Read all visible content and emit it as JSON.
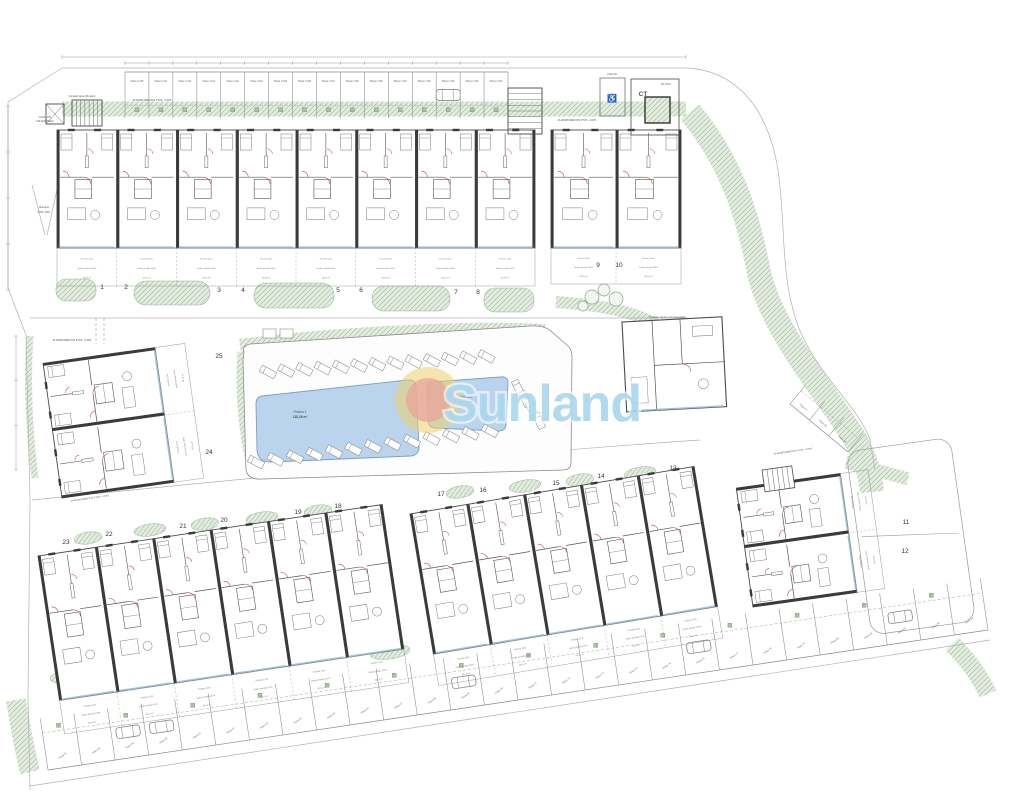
{
  "title": "Residential development site plan",
  "logo": {
    "text": "Sunland",
    "text_color": "#a7d6ee",
    "sun_outer_color": "#f1cf6d",
    "sun_inner_color": "#e9a69c",
    "cx": 428,
    "cy": 400,
    "r_outer": 33,
    "r_inner": 22,
    "text_x": 443,
    "text_y": 421,
    "font_size": 52
  },
  "plan": {
    "colors": {
      "wall": "#3a3a3a",
      "line": "#6a6a6a",
      "faint": "#b0b0b0",
      "red": "#c0392b",
      "blue": "#8fc1dd",
      "pool_fill": "#b9d4ec",
      "pool_edge": "#7d9fc0",
      "green_fill": "#e3ecdf",
      "green_line": "#9cb89c",
      "text": "#444444"
    },
    "terrace_text": [
      "Parcela 123a",
      "Jardín privado 100%",
      "58,16 m²"
    ],
    "unit_numbers": [
      {
        "n": "1",
        "x": 102,
        "y": 289
      },
      {
        "n": "2",
        "x": 126,
        "y": 289
      },
      {
        "n": "3",
        "x": 219,
        "y": 292
      },
      {
        "n": "4",
        "x": 243,
        "y": 292
      },
      {
        "n": "5",
        "x": 338,
        "y": 292
      },
      {
        "n": "6",
        "x": 361,
        "y": 292
      },
      {
        "n": "7",
        "x": 456,
        "y": 294
      },
      {
        "n": "8",
        "x": 478,
        "y": 294
      },
      {
        "n": "9",
        "x": 598,
        "y": 267
      },
      {
        "n": "10",
        "x": 619,
        "y": 267
      },
      {
        "n": "25",
        "x": 219,
        "y": 358
      },
      {
        "n": "24",
        "x": 209,
        "y": 454
      },
      {
        "n": "23",
        "x": 66,
        "y": 544
      },
      {
        "n": "22",
        "x": 109,
        "y": 536
      },
      {
        "n": "21",
        "x": 183,
        "y": 528
      },
      {
        "n": "20",
        "x": 224,
        "y": 522
      },
      {
        "n": "19",
        "x": 298,
        "y": 514
      },
      {
        "n": "18",
        "x": 338,
        "y": 508
      },
      {
        "n": "17",
        "x": 441,
        "y": 496
      },
      {
        "n": "16",
        "x": 483,
        "y": 492
      },
      {
        "n": "15",
        "x": 556,
        "y": 485
      },
      {
        "n": "14",
        "x": 601,
        "y": 478
      },
      {
        "n": "13",
        "x": 673,
        "y": 470
      },
      {
        "n": "11",
        "x": 906,
        "y": 524
      },
      {
        "n": "12",
        "x": 905,
        "y": 553
      }
    ],
    "annotations": [
      {
        "text": "CHALAN",
        "x": 45,
        "y": 118,
        "size": 3
      },
      {
        "text": "DE ESPERA",
        "x": 45,
        "y": 122,
        "size": 3
      },
      {
        "text": "Contador agua (26 apart)",
        "x": 82,
        "y": 97,
        "size": 2.4
      },
      {
        "text": "26 APARTAMENTOS PTOS - COPS",
        "x": 152,
        "y": 101,
        "size": 2.4
      },
      {
        "text": "26 APARTAMENTOS PTOS - COPS",
        "x": 577,
        "y": 121,
        "size": 2.4
      },
      {
        "text": "Rampa",
        "x": 44,
        "y": 208,
        "size": 3
      },
      {
        "text": "PTE 16%",
        "x": 44,
        "y": 213,
        "size": 3
      },
      {
        "text": "26 APARTAMENTOS PTOS - COPS",
        "x": 72,
        "y": 341,
        "size": 2.4
      },
      {
        "text": "26 APARTAMENTOS PTOS - COPS",
        "x": 90,
        "y": 499,
        "size": 2.4,
        "rot": -8
      },
      {
        "text": "26 APARTAMENTOS PTOS - COPS",
        "x": 793,
        "y": 452,
        "size": 2.4,
        "rot": -8
      },
      {
        "text": "Contador agua y luz comunidad",
        "x": 667,
        "y": 318,
        "size": 2.6
      },
      {
        "text": "CT",
        "x": 643,
        "y": 96,
        "size": 6.5,
        "bold": true
      },
      {
        "text": "22,75m²",
        "x": 666,
        "y": 85,
        "size": 2.8
      },
      {
        "text": "Plaza 99",
        "x": 612,
        "y": 75,
        "size": 2.4
      },
      {
        "text": "♿",
        "x": 612,
        "y": 101,
        "size": 8
      },
      {
        "text": "Piscina 1",
        "x": 300,
        "y": 413,
        "size": 3.2
      },
      {
        "text": "138,26 m²",
        "x": 300,
        "y": 418,
        "size": 3.2,
        "bold": true
      },
      {
        "text": "Piscina 2",
        "x": 466,
        "y": 398,
        "size": 3.2
      },
      {
        "text": "56,06 m²",
        "x": 466,
        "y": 403,
        "size": 3.2,
        "bold": true
      }
    ],
    "blocks": [
      {
        "name": "block-units-1-8",
        "x": 57,
        "y": 130,
        "w": 478,
        "h": 118,
        "units": 8,
        "rot": 0,
        "terrace": 38
      },
      {
        "name": "block-units-9-10",
        "x": 551,
        "y": 130,
        "w": 130,
        "h": 118,
        "units": 2,
        "rot": 0,
        "terrace": 36
      },
      {
        "name": "block-units-24-25",
        "x": 62,
        "y": 498,
        "w": 136,
        "h": 113,
        "units": 2,
        "rot": -98,
        "terrace": 30
      },
      {
        "name": "block-units-18-23",
        "x": 38,
        "y": 556,
        "w": 348,
        "h": 146,
        "units": 6,
        "rot": -8.5,
        "terrace": 34
      },
      {
        "name": "block-units-13-17",
        "x": 410,
        "y": 514,
        "w": 288,
        "h": 142,
        "units": 5,
        "rot": -9.5,
        "terrace": 32
      },
      {
        "name": "block-units-11-12",
        "x": 753,
        "y": 607,
        "w": 120,
        "h": 105,
        "units": 2,
        "rot": -98,
        "terrace": 28
      }
    ],
    "pools": [
      {
        "name": "piscina-1",
        "d": "M 262,396 L 408,380 Q 416,379 416,387 L 419,447 Q 419,455 411,456 L 272,462 Q 258,463 257,450 L 256,404 Q 256,397 262,396 Z"
      },
      {
        "name": "piscina-2",
        "d": "M 432,382 L 500,377 Q 508,376 508,383 L 506,424 Q 506,431 498,431 L 436,428 Q 428,428 428,420 L 427,389 Q 427,382 432,382 Z"
      }
    ],
    "pool_enclosure": "M 244,352 Q 242,346 250,344 L 530,326 Q 545,325 552,332 L 568,346 Q 572,350 572,356 L 571,462 Q 571,470 563,470 L 262,479 Q 248,480 246,470 L 243,360 Z",
    "equip_boxes": [
      [
        263,
        329,
        13,
        9
      ],
      [
        280,
        329,
        13,
        9
      ]
    ],
    "lounger_rows": [
      {
        "x": 268,
        "y": 372,
        "n": 13,
        "dx": 18.2,
        "dy": -1.3,
        "ang": -62
      },
      {
        "x": 256,
        "y": 462,
        "n": 13,
        "dx": 19.5,
        "dy": -2.6,
        "ang": -62
      },
      {
        "x": 518,
        "y": 388,
        "n": 4,
        "dx": 7,
        "dy": 11,
        "ang": -25
      }
    ],
    "green_bands": [
      {
        "d": "M 62,109 H 686",
        "w": 15
      },
      {
        "d": "M 690,112 C 730,160 748,215 758,268 C 768,322 816,380 848,428 C 862,448 870,470 872,492",
        "w": 24
      },
      {
        "d": "M 556,302 C 615,306 655,316 676,340",
        "w": 12
      },
      {
        "d": "M 240,346 C 330,334 470,327 545,331",
        "w": 14
      },
      {
        "d": "M 242,352 C 239,392 243,432 252,470",
        "w": 9
      },
      {
        "d": "M 846,462 L 908,479",
        "w": 13
      },
      {
        "d": "M 30,336 C 27,380 29,430 35,478",
        "w": 7
      },
      {
        "d": "M 952,644 C 968,660 980,676 988,694",
        "w": 18
      },
      {
        "d": "M 16,700 C 20,724 24,748 30,772",
        "w": 20
      }
    ],
    "hedges": [
      {
        "x": 56,
        "y": 279,
        "w": 40,
        "h": 22,
        "rx": 10
      },
      {
        "x": 134,
        "y": 281,
        "w": 76,
        "h": 24,
        "rx": 12
      },
      {
        "x": 254,
        "y": 283,
        "w": 80,
        "h": 25,
        "rx": 12
      },
      {
        "x": 372,
        "y": 286,
        "w": 78,
        "h": 25,
        "rx": 12
      },
      {
        "x": 484,
        "y": 288,
        "w": 50,
        "h": 24,
        "rx": 11
      }
    ],
    "bushes": [
      {
        "cx": 88,
        "cy": 538,
        "rx": 14,
        "ry": 6,
        "rot": -8
      },
      {
        "cx": 150,
        "cy": 530,
        "rx": 16,
        "ry": 6,
        "rot": -8
      },
      {
        "cx": 205,
        "cy": 524,
        "rx": 14,
        "ry": 6,
        "rot": -8
      },
      {
        "cx": 262,
        "cy": 518,
        "rx": 16,
        "ry": 6,
        "rot": -8
      },
      {
        "cx": 318,
        "cy": 511,
        "rx": 14,
        "ry": 6,
        "rot": -8
      },
      {
        "cx": 460,
        "cy": 492,
        "rx": 14,
        "ry": 6,
        "rot": -9
      },
      {
        "cx": 525,
        "cy": 486,
        "rx": 16,
        "ry": 6,
        "rot": -9
      },
      {
        "cx": 580,
        "cy": 480,
        "rx": 14,
        "ry": 6,
        "rot": -9
      },
      {
        "cx": 640,
        "cy": 473,
        "rx": 16,
        "ry": 6,
        "rot": -9
      },
      {
        "cx": 70,
        "cy": 676,
        "rx": 20,
        "ry": 7,
        "rot": -8
      },
      {
        "cx": 245,
        "cy": 666,
        "rx": 26,
        "ry": 7,
        "rot": -8
      },
      {
        "cx": 390,
        "cy": 652,
        "rx": 20,
        "ry": 7,
        "rot": -8
      }
    ],
    "trees": [
      {
        "cx": 592,
        "cy": 297,
        "r": 7
      },
      {
        "cx": 604,
        "cy": 290,
        "r": 6
      },
      {
        "cx": 616,
        "cy": 299,
        "r": 7
      },
      {
        "cx": 583,
        "cy": 306,
        "r": 5
      }
    ],
    "lines": [
      {
        "d": "M 8,102 L 62,68"
      },
      {
        "d": "M 62,68 H 688"
      },
      {
        "d": "M 8,102 L 8,288 L 26,335 L 30,500 L 28,698 L 30,790"
      },
      {
        "d": "M 688,68 C 745,72 770,120 778,170 C 786,225 780,270 796,320 C 812,370 860,408 870,440 L 875,470"
      },
      {
        "d": "M 30,318 H 688"
      },
      {
        "d": "M 96,318 V 344",
        "dash": "3,2"
      },
      {
        "d": "M 104,318 V 344",
        "dash": "3,2"
      },
      {
        "d": "M 538,332 V 470",
        "dash": "3,2"
      },
      {
        "d": "M 547,332 V 468",
        "dash": "3,2"
      },
      {
        "d": "M 32,500 C 250,478 520,452 700,440"
      },
      {
        "d": "M 30,786 L 990,640"
      },
      {
        "d": "M 32,185 L 45,235"
      },
      {
        "d": "M 58,185 L 47,235"
      }
    ],
    "garden_enclosure_11_12": {
      "x": 846,
      "y": 452,
      "w": 105,
      "h": 185,
      "rx": 14,
      "rot": -8
    },
    "dims": [
      {
        "x1": 125,
        "y1": 63,
        "x2": 508,
        "y2": 63,
        "ticks": 16
      },
      {
        "x1": 62,
        "y1": 57,
        "x2": 686,
        "y2": 57,
        "ticks": 1
      },
      {
        "x1": 8,
        "y1": 106,
        "x2": 8,
        "y2": 290,
        "ticks": 4
      },
      {
        "x1": 16,
        "y1": 336,
        "x2": 16,
        "y2": 470,
        "ticks": 3
      }
    ],
    "parking_rows": [
      {
        "name": "parking-row-top",
        "x1": 125,
        "y1": 72,
        "x2": 508,
        "y2": 72,
        "n": 16,
        "depth": 46,
        "side": 1,
        "labelRot": 0,
        "labels": [
          "Plaza nº115",
          "Plaza nº114",
          "Plaza nº113",
          "Plaza nº112",
          "Plaza nº111",
          "Plaza nº110",
          "Plaza nº109",
          "Plaza nº108",
          "Plaza nº107",
          "Plaza nº106",
          "Plaza nº105",
          "Plaza nº104",
          "Plaza nº103",
          "Plaza nº102",
          "Plaza nº101",
          "Plaza nº100"
        ],
        "cars": [
          13
        ],
        "squares": 1
      },
      {
        "name": "parking-row-bottom",
        "x1": 48,
        "y1": 770,
        "x2": 988,
        "y2": 630,
        "n": 28,
        "depth": 52,
        "side": -1,
        "labelRot": -35,
        "labels": [
          "Plaza 57",
          "Plaza 58",
          "Plaza 59",
          "Plaza 60",
          "Plaza 61",
          "Plaza 62",
          "Plaza 63",
          "Plaza 64",
          "Plaza 65",
          "Plaza 66",
          "Plaza 67",
          "Plaza 68",
          "Plaza 69",
          "Plaza 70",
          "Plaza 71",
          "Plaza 72",
          "Plaza 73",
          "Plaza 74",
          "Plaza 75",
          "Plaza 76",
          "Plaza 77",
          "Plaza 78",
          "Plaza 79",
          "Plaza 80",
          "Plaza 81",
          "Plaza 82",
          "Plaza 83",
          "Plaza 84"
        ],
        "cars": [
          2,
          3,
          12,
          19,
          25
        ],
        "squares": 2
      },
      {
        "name": "parking-row-curve",
        "x1": 790,
        "y1": 404,
        "x2": 848,
        "y2": 452,
        "n": 3,
        "depth": 24,
        "side": -1,
        "labelRot": 40,
        "labels": [
          "Plaza 97",
          "Plaza 96",
          "Plaza 95"
        ],
        "cars": [],
        "squares": 0
      }
    ],
    "structures": {
      "ct_outer": [
        631,
        79,
        48,
        56
      ],
      "ct_inner": [
        645,
        97,
        25,
        26
      ],
      "handicap_space": [
        600,
        78,
        25,
        38
      ],
      "lift1": [
        46,
        104,
        18,
        20
      ],
      "stairs1": [
        72,
        100,
        30,
        26
      ],
      "stairs2": [
        508,
        88,
        34,
        46
      ],
      "stairs3": {
        "x": 762,
        "y": 470,
        "w": 30,
        "h": 22,
        "rot": -8
      },
      "community": {
        "x": 622,
        "y": 322,
        "w": 100,
        "h": 90,
        "rot": -3
      }
    }
  }
}
